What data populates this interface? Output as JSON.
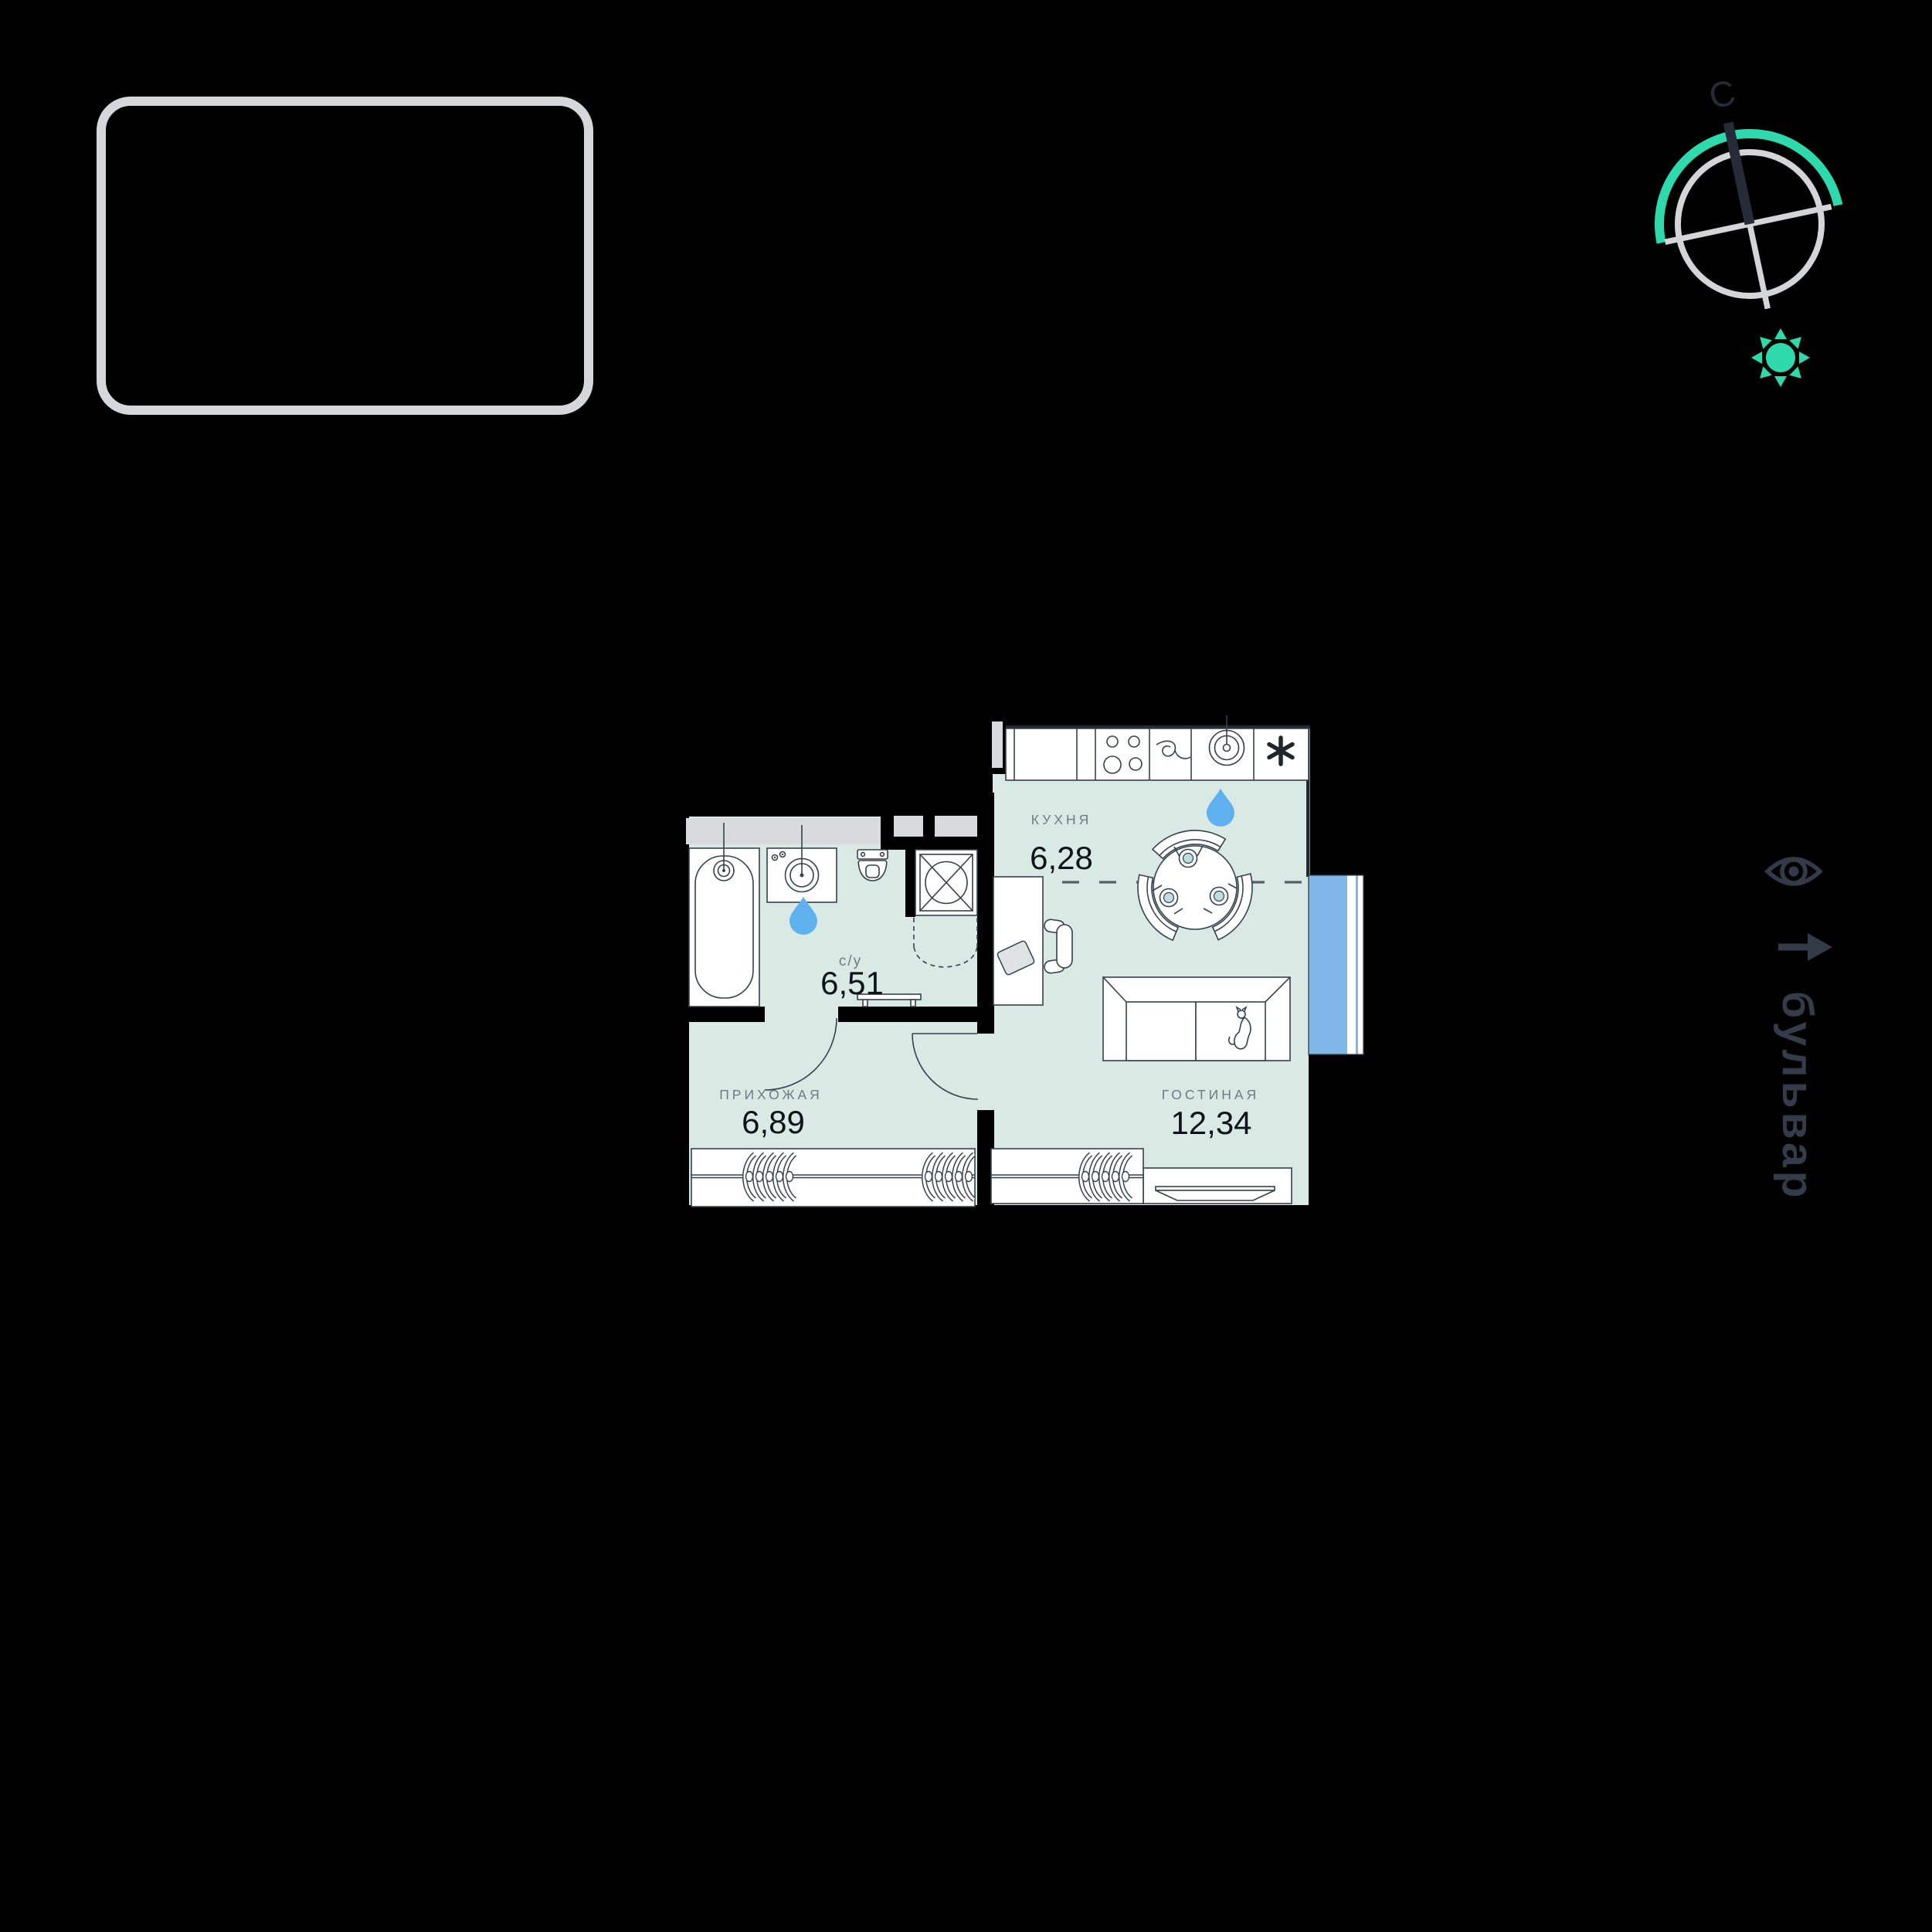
{
  "page": {
    "background": "#000000"
  },
  "compass": {
    "north_label": "С",
    "ring_color": "#d3d5d7",
    "needle_color": "#262c37",
    "accent_color": "#2ed9ac"
  },
  "floor_plan": {
    "colors": {
      "room_fill": "#d9e9e4",
      "wall": "#000000",
      "outline": "#35414c",
      "shaft_fill": "#d7dbdc",
      "window_blue": "#7fb8e8",
      "water_drop": "#5fb0ee",
      "room_label": "#6e7a84",
      "area_value": "#0d1318",
      "plate_fill": "#bfdde0"
    },
    "rooms": [
      {
        "id": "kitchen",
        "label": "КУХНЯ",
        "area": "6,28"
      },
      {
        "id": "bathroom",
        "label": "с/у",
        "area": "6,51"
      },
      {
        "id": "hallway",
        "label": "ПРИХОЖАЯ",
        "area": "6,89"
      },
      {
        "id": "living",
        "label": "ГОСТИНАЯ",
        "area": "12,34"
      }
    ],
    "fixtures": [
      "bathtub",
      "washbasin",
      "toilet",
      "washing-machine",
      "kitchen-counter",
      "stove",
      "kitchen-sink",
      "fridge",
      "dining-table",
      "chairs",
      "desk",
      "office-chair",
      "sofa",
      "cat",
      "tv-stand",
      "wardrobe",
      "clothes-hangers",
      "water-drop",
      "balcony-window",
      "door-swing"
    ]
  },
  "street_label": {
    "text": "бульвар"
  }
}
